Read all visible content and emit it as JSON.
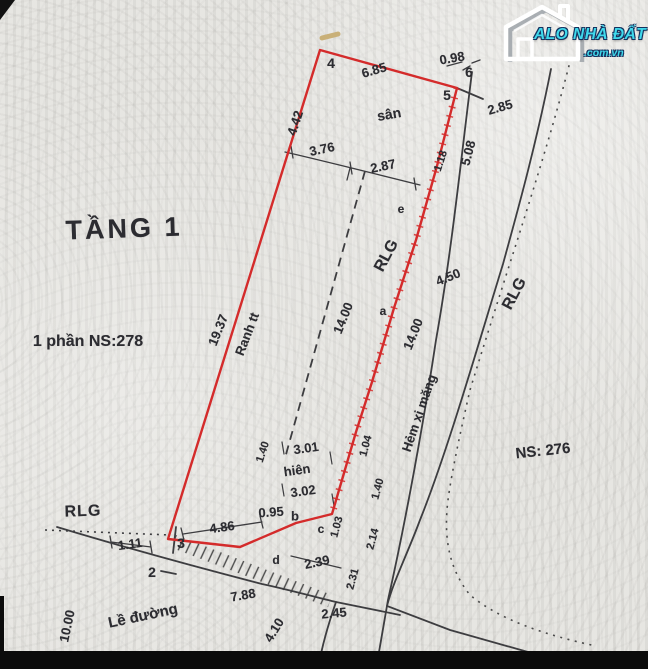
{
  "watermark": {
    "icon": "house-icon",
    "brand": "ALO NHÀ ĐẤT",
    "tld": ".com.vn",
    "brand_color": "#3fd9ec"
  },
  "plan": {
    "boundary_color": "#d42b2b",
    "line_color": "#3d3d40",
    "text_color": "#2c2c31",
    "paper_color": "#e2e1dd",
    "labels": [
      {
        "id": "title-tang-1",
        "text": "TẦNG 1",
        "x": 124,
        "y": 229,
        "rot": -2,
        "size": 27,
        "ls": 3
      },
      {
        "id": "parcel-ns278",
        "text": "1 phần NS:278",
        "x": 88,
        "y": 342,
        "rot": 0,
        "size": 16
      },
      {
        "id": "parcel-ns276",
        "text": "NS: 276",
        "x": 543,
        "y": 451,
        "rot": -6,
        "size": 15
      },
      {
        "id": "rlg-left",
        "text": "RLG",
        "x": 83,
        "y": 512,
        "rot": -2,
        "size": 16,
        "ls": 1
      },
      {
        "id": "rlg-mid",
        "text": "RLG",
        "x": 387,
        "y": 256,
        "rot": -62,
        "size": 16
      },
      {
        "id": "rlg-right",
        "text": "RLG",
        "x": 515,
        "y": 294,
        "rot": -62,
        "size": 16
      },
      {
        "id": "label-san",
        "text": "sân",
        "x": 389,
        "y": 114,
        "rot": -10,
        "size": 14
      },
      {
        "id": "label-hien",
        "text": "hiên",
        "x": 297,
        "y": 470,
        "rot": -8,
        "size": 13
      },
      {
        "id": "label-hem-xi-mang",
        "text": "Hẻm xi măng",
        "x": 419,
        "y": 413,
        "rot": -71,
        "size": 13
      },
      {
        "id": "label-le-duong",
        "text": "Lề đường",
        "x": 143,
        "y": 616,
        "rot": -12,
        "size": 15
      },
      {
        "id": "label-ranh-tt",
        "text": "Ranh tt",
        "x": 247,
        "y": 334,
        "rot": -69,
        "size": 13
      },
      {
        "id": "dim-6-85",
        "text": "6.85",
        "x": 374,
        "y": 70,
        "rot": -16,
        "size": 13
      },
      {
        "id": "dim-0-98",
        "text": "0.98",
        "x": 452,
        "y": 58,
        "rot": -10,
        "size": 13
      },
      {
        "id": "dim-2-85",
        "text": "2.85",
        "x": 500,
        "y": 107,
        "rot": -16,
        "size": 13
      },
      {
        "id": "dim-4-42",
        "text": "4.42",
        "x": 295,
        "y": 123,
        "rot": -72,
        "size": 13
      },
      {
        "id": "dim-3-76",
        "text": "3.76",
        "x": 322,
        "y": 149,
        "rot": -12,
        "size": 13
      },
      {
        "id": "dim-2-87",
        "text": "2.87",
        "x": 383,
        "y": 166,
        "rot": -12,
        "size": 13
      },
      {
        "id": "dim-1-18",
        "text": "1.18",
        "x": 441,
        "y": 161,
        "rot": -72,
        "size": 11
      },
      {
        "id": "dim-5-08",
        "text": "5.08",
        "x": 468,
        "y": 153,
        "rot": -75,
        "size": 13
      },
      {
        "id": "dim-19-37",
        "text": "19.37",
        "x": 218,
        "y": 330,
        "rot": -68,
        "size": 13
      },
      {
        "id": "dim-14-00-ranh",
        "text": "14.00",
        "x": 343,
        "y": 318,
        "rot": -68,
        "size": 13
      },
      {
        "id": "dim-4-50",
        "text": "4.50",
        "x": 448,
        "y": 277,
        "rot": -22,
        "size": 13
      },
      {
        "id": "dim-14-00-hem",
        "text": "14.00",
        "x": 413,
        "y": 334,
        "rot": -68,
        "size": 13
      },
      {
        "id": "dim-1-40-hien",
        "text": "1.40",
        "x": 263,
        "y": 452,
        "rot": -72,
        "size": 11
      },
      {
        "id": "dim-3-01",
        "text": "3.01",
        "x": 306,
        "y": 448,
        "rot": -8,
        "size": 13
      },
      {
        "id": "dim-3-02",
        "text": "3.02",
        "x": 303,
        "y": 491,
        "rot": -8,
        "size": 13
      },
      {
        "id": "dim-0-95",
        "text": "0.95",
        "x": 271,
        "y": 512,
        "rot": -4,
        "size": 13
      },
      {
        "id": "dim-1-03",
        "text": "1.03",
        "x": 337,
        "y": 527,
        "rot": -75,
        "size": 11
      },
      {
        "id": "dim-1-04",
        "text": "1.04",
        "x": 366,
        "y": 446,
        "rot": -75,
        "size": 11
      },
      {
        "id": "dim-1-40-hem",
        "text": "1.40",
        "x": 378,
        "y": 489,
        "rot": -75,
        "size": 11
      },
      {
        "id": "dim-2-14",
        "text": "2.14",
        "x": 373,
        "y": 539,
        "rot": -75,
        "size": 11
      },
      {
        "id": "dim-2-31",
        "text": "2.31",
        "x": 353,
        "y": 579,
        "rot": -75,
        "size": 11
      },
      {
        "id": "dim-2-39",
        "text": "2.39",
        "x": 317,
        "y": 562,
        "rot": -12,
        "size": 13
      },
      {
        "id": "dim-2-45",
        "text": "2.45",
        "x": 334,
        "y": 613,
        "rot": -5,
        "size": 13
      },
      {
        "id": "dim-4-86",
        "text": "4.86",
        "x": 222,
        "y": 527,
        "rot": -8,
        "size": 13
      },
      {
        "id": "dim-1-11",
        "text": "1.11",
        "x": 130,
        "y": 544,
        "rot": -8,
        "size": 13
      },
      {
        "id": "dim-7-88",
        "text": "7.88",
        "x": 243,
        "y": 595,
        "rot": -10,
        "size": 13
      },
      {
        "id": "dim-4-10",
        "text": "4.10",
        "x": 274,
        "y": 630,
        "rot": -58,
        "size": 13
      },
      {
        "id": "dim-10-00",
        "text": "10.00",
        "x": 67,
        "y": 626,
        "rot": -78,
        "size": 13
      },
      {
        "id": "point-2",
        "text": "2",
        "x": 152,
        "y": 572,
        "rot": 0,
        "size": 14
      },
      {
        "id": "point-3",
        "text": "3",
        "x": 181,
        "y": 543,
        "rot": 0,
        "size": 14
      },
      {
        "id": "point-4",
        "text": "4",
        "x": 331,
        "y": 63,
        "rot": 0,
        "size": 14
      },
      {
        "id": "point-5",
        "text": "5",
        "x": 447,
        "y": 95,
        "rot": 0,
        "size": 14
      },
      {
        "id": "point-6",
        "text": "6",
        "x": 469,
        "y": 72,
        "rot": 0,
        "size": 14
      },
      {
        "id": "point-a",
        "text": "a",
        "x": 383,
        "y": 311,
        "rot": 0,
        "size": 12
      },
      {
        "id": "point-b",
        "text": "b",
        "x": 295,
        "y": 516,
        "rot": 0,
        "size": 13
      },
      {
        "id": "point-c",
        "text": "c",
        "x": 321,
        "y": 529,
        "rot": 0,
        "size": 12
      },
      {
        "id": "point-d",
        "text": "d",
        "x": 276,
        "y": 560,
        "rot": 0,
        "size": 12
      },
      {
        "id": "point-e",
        "text": "e",
        "x": 401,
        "y": 209,
        "rot": 0,
        "size": 12
      }
    ]
  }
}
